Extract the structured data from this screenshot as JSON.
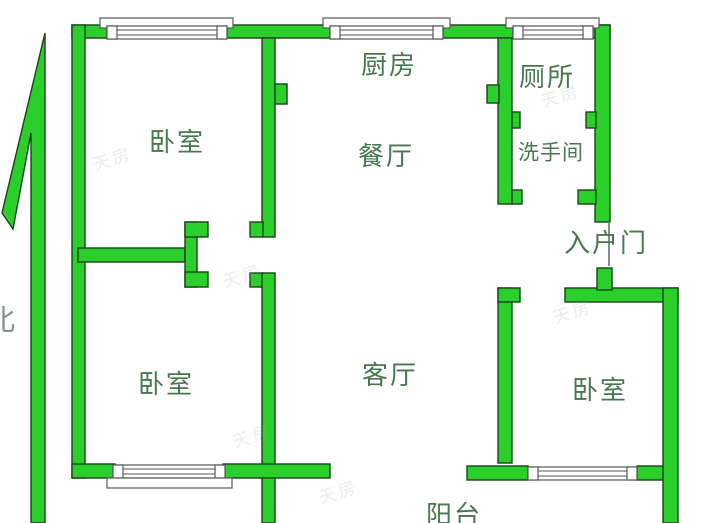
{
  "floorplan": {
    "rooms": [
      {
        "id": "bedroom-top-left",
        "label": "卧室"
      },
      {
        "id": "kitchen",
        "label": "厨房"
      },
      {
        "id": "toilet",
        "label": "厕所"
      },
      {
        "id": "dining-room",
        "label": "餐厅"
      },
      {
        "id": "washroom",
        "label": "洗手间"
      },
      {
        "id": "entry-door",
        "label": "入户门"
      },
      {
        "id": "bedroom-bottom-left",
        "label": "卧室"
      },
      {
        "id": "living-room",
        "label": "客厅"
      },
      {
        "id": "bedroom-bottom-right",
        "label": "卧室"
      },
      {
        "id": "balcony",
        "label": "阳台"
      }
    ],
    "compass": {
      "label": "北"
    },
    "watermark": {
      "text": "天房"
    },
    "colors": {
      "wall_fill": "#2bcf2b",
      "wall_outline": "#194219",
      "label_text": "#47774d",
      "compass_text": "#83928a",
      "window_outline": "#565656",
      "background": "#ffffff"
    }
  }
}
